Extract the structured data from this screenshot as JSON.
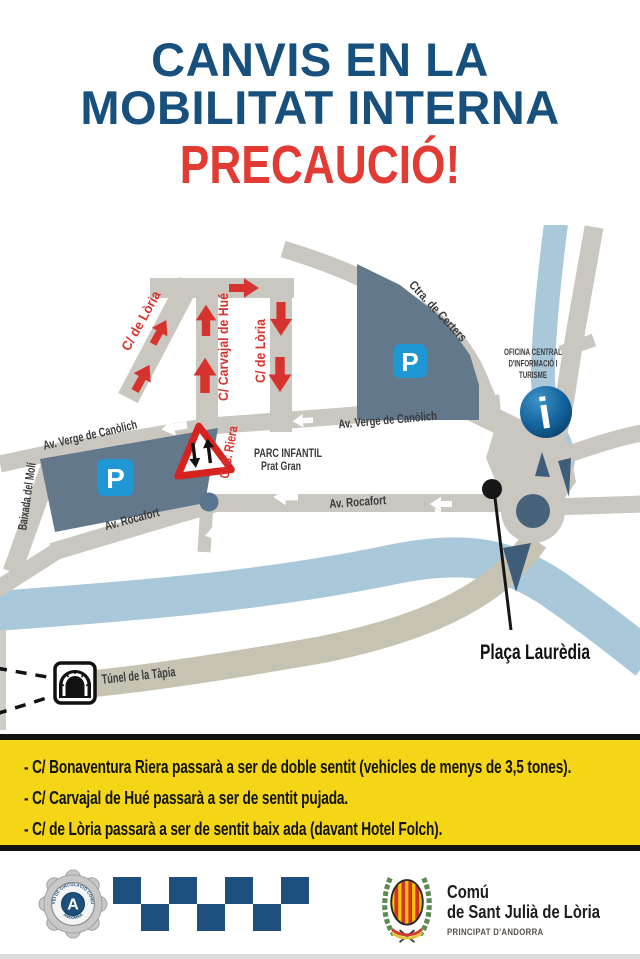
{
  "title": {
    "line1": "CANVIS EN LA",
    "line2": "MOBILITAT INTERNA",
    "warning": "PRECAUCIÓ!"
  },
  "map": {
    "labels": {
      "loria_diagonal": "C/ de Lòria",
      "carvajal": "C/ Carvajal de Hué",
      "loria_vertical": "C/ de Lòria",
      "certers": "Ctra. de Certers",
      "oficina_line1": "OFICINA CENTRAL",
      "oficina_line2": "D'INFORMACIÓ I",
      "oficina_line3": "TURISME",
      "canolich_west": "Av. Verge de Canòlich",
      "canolich_east": "Av. Verge de Canòlich",
      "b_riera": "C/ B. Riera",
      "parc_line1": "PARC INFANTIL",
      "parc_line2": "Prat Gran",
      "rocafort_west": "Av. Rocafort",
      "rocafort_east": "Av. Rocafort",
      "baixada": "Baixada del Molí",
      "tunel": "Túnel de la Tàpia",
      "placa": "Plaça Laurèdia",
      "parking": "P",
      "info": "i"
    },
    "colors": {
      "street": "#c9c7bf",
      "tunnel_road": "#c6c3b3",
      "river": "#a9c9db",
      "parking_area": "#64788c",
      "parking_icon": "#1e97d4",
      "arrow_red": "#d6332e",
      "roundabout_center": "#47637c",
      "title_blue": "#17507c",
      "warning_red": "#e23b33",
      "banner_yellow": "#f5d617"
    }
  },
  "banner": {
    "items": [
      "- C/ Bonaventura Riera passarà a ser de doble sentit (vehicles de menys de 3,5 tones).",
      "- C/ Carvajal de Hué passarà a ser de sentit pujada.",
      "- C/ de Lòria passarà a ser de sentit baix ada (davant Hotel Folch)."
    ]
  },
  "footer": {
    "badge": {
      "arc_top": "SERVEI DE CIRCULACIÓ COMUNAL",
      "letter": "A",
      "arc_bottom": "ANDORRA"
    },
    "org": {
      "name_line1": "Comú",
      "name_line2": "de Sant Julià de Lòria",
      "country": "PRINCIPAT D'ANDORRA"
    }
  }
}
